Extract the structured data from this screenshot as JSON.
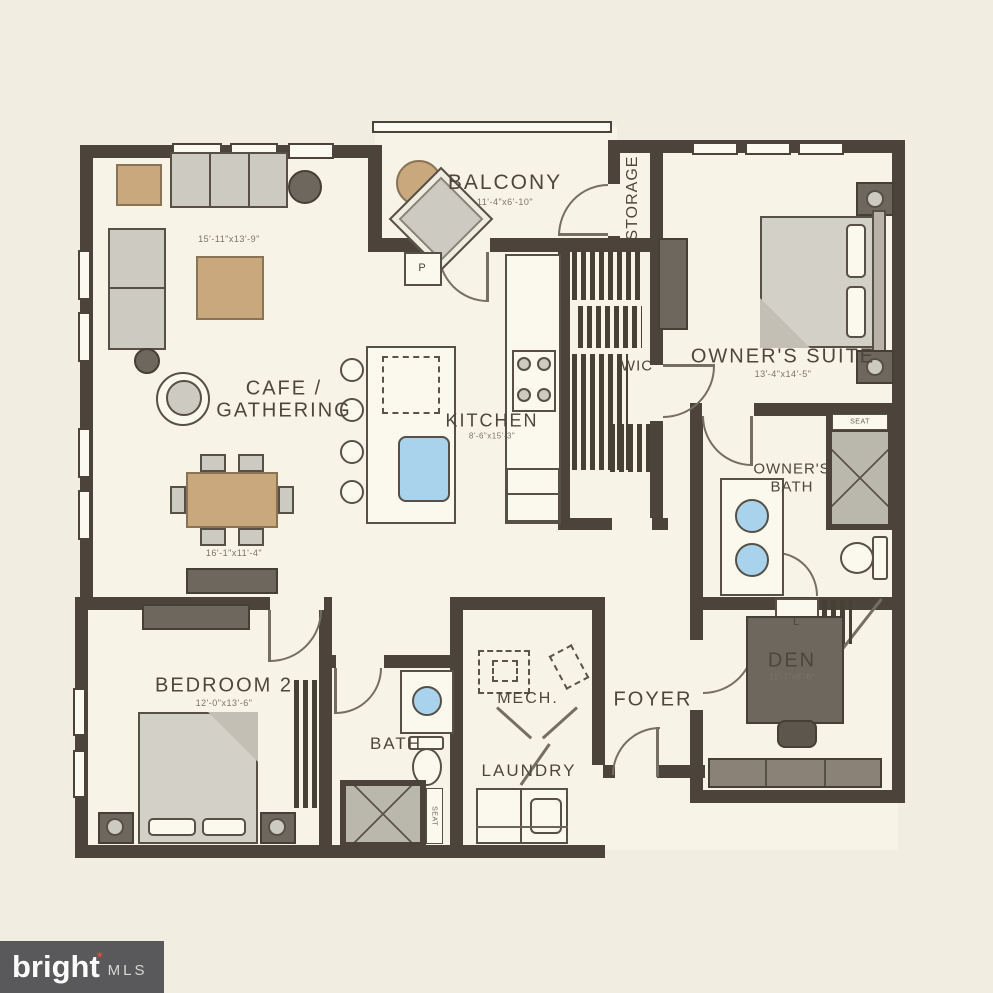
{
  "colors": {
    "wall": "#4c443a",
    "floor": "#f7f3e6",
    "background": "#f1ede0",
    "tan": "#c9a87e",
    "sink_blue": "#a9d3ec",
    "logo_bg": "#59595b",
    "logo_star": "#e05f2d"
  },
  "logo": {
    "brand": "bright",
    "star": "*",
    "suffix": "MLS"
  },
  "rooms": {
    "balcony": {
      "label": "BALCONY",
      "dim": "11'-4\"x6'-10\""
    },
    "storage": {
      "label": "STORAGE"
    },
    "owners_suite": {
      "label": "OWNER'S SUITE",
      "dim": "13'-4\"x14'-5\""
    },
    "wic": {
      "label": "WIC"
    },
    "cafe_gathering": {
      "line1": "CAFE /",
      "line2": "GATHERING",
      "living_dim": "15'-11\"x13'-9\"",
      "dining_dim": "16'-1\"x11'-4\""
    },
    "kitchen": {
      "label": "KITCHEN",
      "dim": "8'-6\"x15'-3\""
    },
    "owners_bath": {
      "line1": "OWNER'S",
      "line2": "BATH",
      "seat": "SEAT",
      "linen": "L"
    },
    "bedroom2": {
      "label": "BEDROOM 2",
      "dim": "12'-0\"x13'-6\""
    },
    "bath2": {
      "label": "BATH",
      "seat": "SEAT"
    },
    "mech": {
      "label": "MECH."
    },
    "laundry": {
      "label": "LAUNDRY"
    },
    "foyer": {
      "label": "FOYER"
    },
    "den": {
      "label": "DEN",
      "dim": "11'-7\"x8'-6\""
    },
    "pantry": {
      "label": "P"
    }
  }
}
